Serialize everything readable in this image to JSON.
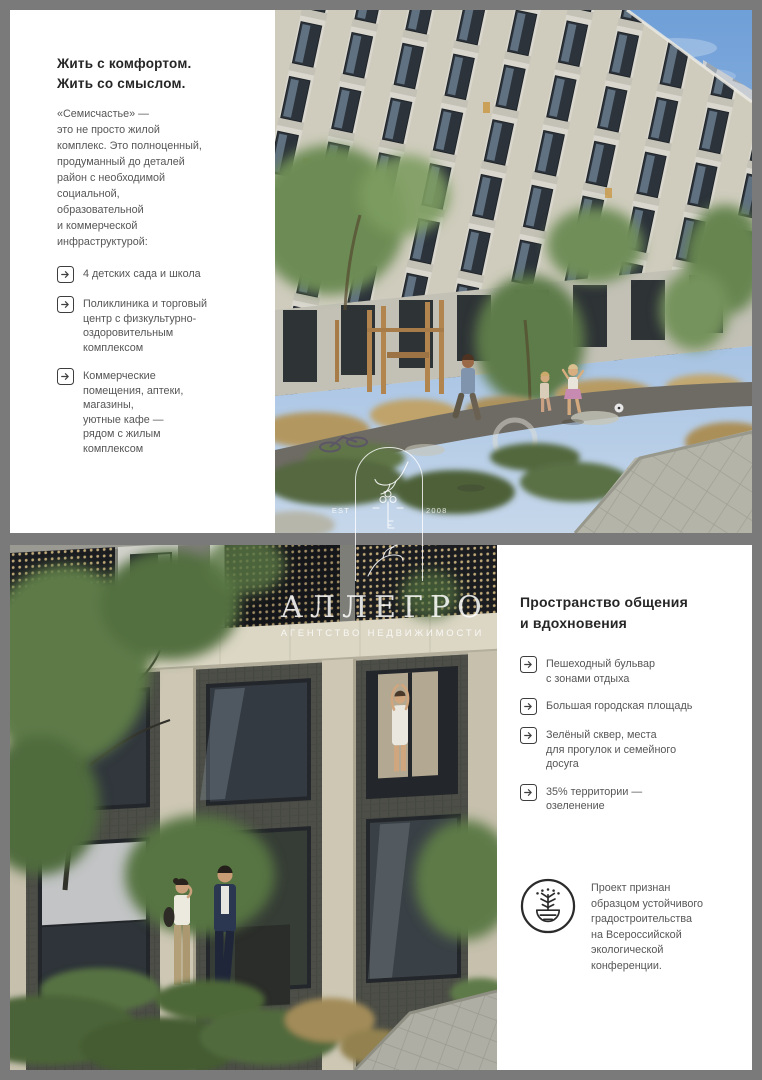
{
  "top_panel": {
    "heading": "Жить с комфортом.\nЖить со смыслом.",
    "intro": "«Семисчастье» —\nэто не просто жилой\nкомплекс. Это полноценный,\nпродуманный до деталей\nрайон с необходимой\nсоциальной,\nобразовательной\nи коммерческой\nинфраструктурой:",
    "bullets": [
      "4 детских сада и школа",
      "Поликлиника и торговый\nцентр с физкультурно-\nоздоровительным\nкомплексом",
      "Коммерческие\nпомещения, аптеки,\nмагазины,\nуютные кафе —\nрядом с жилым\nкомплексом"
    ]
  },
  "bottom_panel": {
    "heading": "Пространство общения\nи вдохновения",
    "bullets": [
      "Пешеходный бульвар\nс зонами отдыха",
      "Большая городская площадь",
      "Зелёный сквер, места\nдля прогулок и семейного\nдосуга",
      "35% территории —\nозеленение"
    ],
    "award_text": "Проект признан\nобразцом устойчивого\nградостроительства\nна Всероссийской\nэкологической\nконференции."
  },
  "watermark": {
    "est": "EST",
    "year": "2008",
    "brand": "АЛЛЕГРО",
    "tagline": "АГЕНТСТВО НЕДВИЖИМОСТИ"
  },
  "icons": {
    "bullet": "arrow-right-box-icon",
    "award": "eco-award-medal-icon",
    "watermark": "allegro-arch-hands-key-logo"
  },
  "colors": {
    "frame": "#7a7a7a",
    "panel": "#ffffff",
    "heading": "#262626",
    "body": "#565656",
    "watermark": "rgba(255,255,255,0.8)"
  }
}
